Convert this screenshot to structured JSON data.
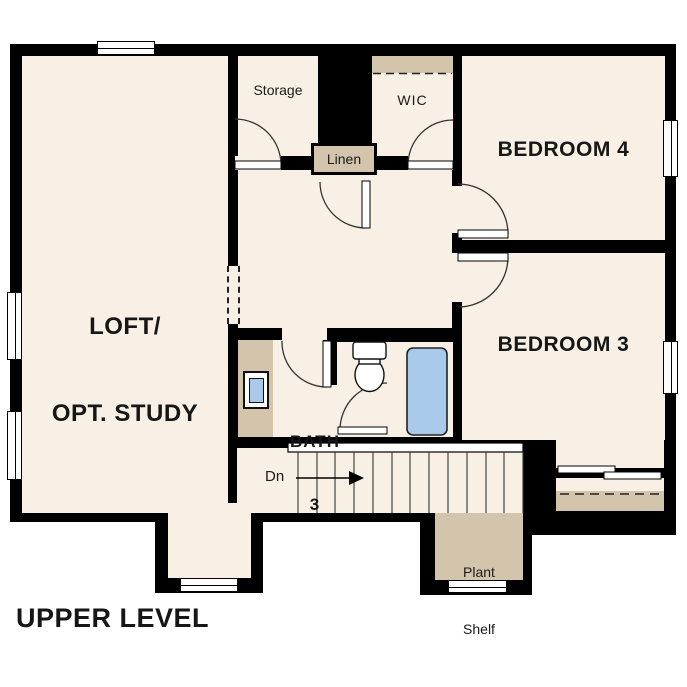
{
  "plan_title": "UPPER LEVEL",
  "rooms": {
    "loft": {
      "line1": "LOFT/",
      "line2": "OPT. STUDY"
    },
    "storage": {
      "label": "Storage"
    },
    "wic": {
      "label": "WIC"
    },
    "linen": {
      "label": "Linen"
    },
    "bedroom4": {
      "label": "BEDROOM 4"
    },
    "bedroom3": {
      "label": "BEDROOM 3"
    },
    "bath": {
      "line1": "BATH",
      "line2": "3"
    },
    "plant_shelf": {
      "line1": "Plant",
      "line2": "Shelf"
    }
  },
  "stairs": {
    "down_label": "Dn"
  },
  "colors": {
    "background": "#ffffff",
    "wall": "#000000",
    "floor": "#f8f0e4",
    "accent_tan": "#d2c5ac",
    "fixture_blue": "#a9c9ea"
  }
}
